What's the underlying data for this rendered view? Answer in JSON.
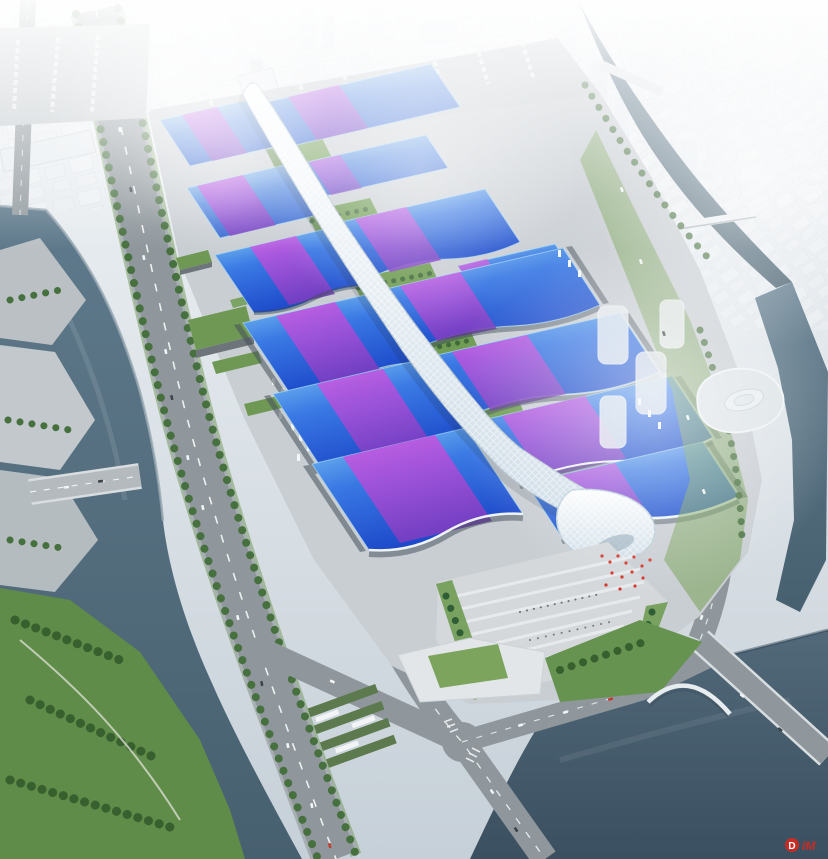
{
  "scene": {
    "subject_label": "aerial rendering of exhibition center",
    "watermark": {
      "badge_letter": "D",
      "suffix": "IM",
      "color": "#d6281e"
    }
  },
  "palette": {
    "roof_blue_deep": "#1b46c8",
    "roof_blue_mid": "#3a79e4",
    "roof_blue_light": "#84cdf2",
    "roof_purple": "#a44fd8",
    "roof_magenta": "#d05ce4",
    "ribbon_white": "#f7fafc",
    "water_river": "#55707f",
    "water_lake": "#42596b",
    "tree_green": "#47703f",
    "lawn_green": "#6f9b52",
    "road_gray": "#8f979c",
    "site_gray": "#c9ced3",
    "plaza_gray": "#d4d8db",
    "haze_white": "#f2f5f7",
    "flag_red": "#d6352b"
  }
}
